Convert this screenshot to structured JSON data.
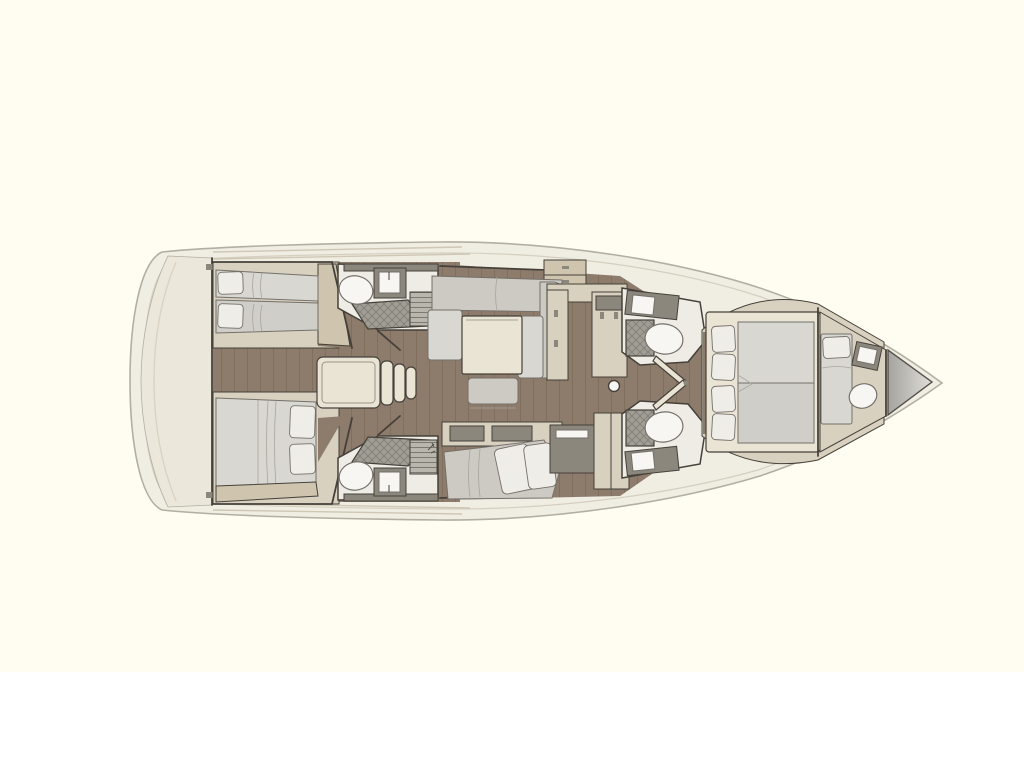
{
  "figure": {
    "kind": "sailing-yacht-interior-floor-plan",
    "orientation": "bow-right",
    "visible_text": "none"
  },
  "rooms": [
    {
      "name": "stern-deck"
    },
    {
      "name": "aft-cabin-port",
      "furniture": [
        "twin-bed",
        "twin-bed"
      ]
    },
    {
      "name": "aft-head-port",
      "fixtures": [
        "toilet",
        "sink",
        "shower",
        "grate"
      ]
    },
    {
      "name": "companionway",
      "fixtures": [
        "engine-box",
        "steps"
      ]
    },
    {
      "name": "aft-cabin-starboard",
      "furniture": [
        "double-bed"
      ]
    },
    {
      "name": "aft-head-starboard",
      "fixtures": [
        "toilet",
        "sink",
        "shower",
        "grate"
      ]
    },
    {
      "name": "salon",
      "furniture": [
        "l-sofa",
        "table",
        "stool",
        "sideboard"
      ]
    },
    {
      "name": "galley",
      "fixtures": [
        "u-counter",
        "mast-post"
      ]
    },
    {
      "name": "lounge-nav",
      "furniture": [
        "chaise",
        "counter",
        "tall-cabinet"
      ]
    },
    {
      "name": "forward-head-port",
      "fixtures": [
        "toilet",
        "sink",
        "shower"
      ]
    },
    {
      "name": "forward-head-starboard",
      "fixtures": [
        "toilet",
        "sink",
        "shower"
      ]
    },
    {
      "name": "owner-cabin",
      "furniture": [
        "island-double-bed",
        "pillows-4"
      ]
    },
    {
      "name": "crew-cabin",
      "furniture": [
        "single-bed",
        "toilet",
        "sink"
      ]
    },
    {
      "name": "bow-sail-locker"
    }
  ],
  "colors": {
    "bg": "#ffffff",
    "bgtint": "#fffdf2",
    "hullring": "#f0ede3",
    "hullstroke": "#b3aea2",
    "innerline": "#d5cfc0",
    "sterndeck": "#ebe7da",
    "wood": "#8d7b6b",
    "plank": "#5f4d3d",
    "roomfloor": "#efece6",
    "cream": "#d9d1c0",
    "creamlight": "#e9e4d4",
    "creamdark": "#cfc5ae",
    "wall": "#45413a",
    "mattress": "#d8d7d2",
    "mattress2": "#cfcec8",
    "mattedge": "#75706a",
    "pillow": "#efede8",
    "foldline": "#a9a59c",
    "fixwhite": "#f7f6f3",
    "fixgray": "#8b877d",
    "showerbg": "#a09d94",
    "showerline": "#6c6861",
    "gratebg": "#b9b6ad",
    "grateline": "#76726a",
    "chaise": "#cdcac3",
    "deckline": "#cfc7b4",
    "locker1": "#a5a39e",
    "locker2": "#e0ded9"
  }
}
